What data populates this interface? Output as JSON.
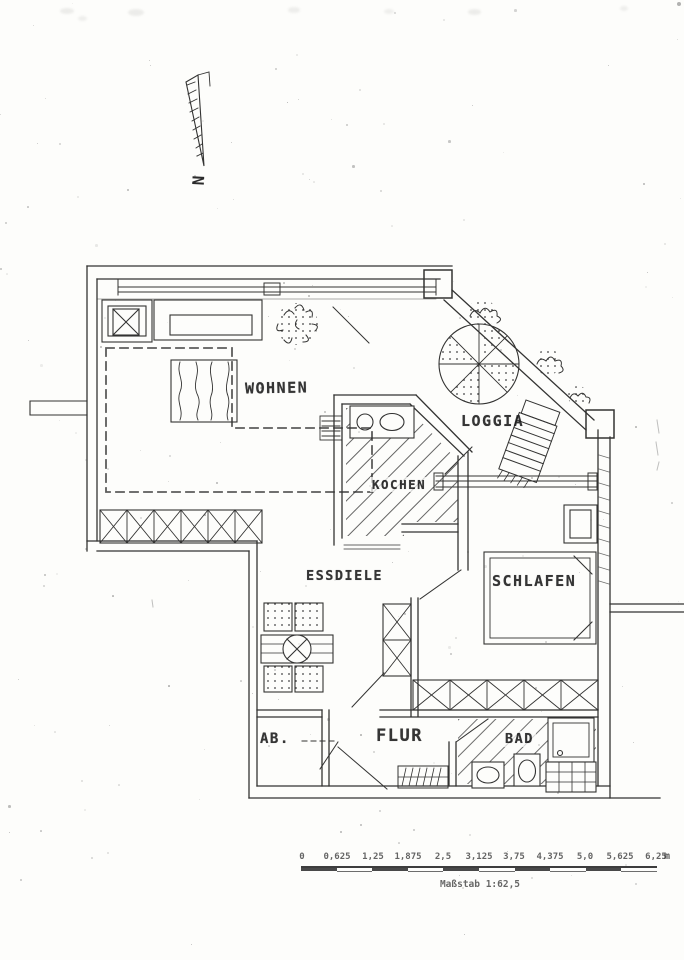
{
  "north": {
    "label": "N"
  },
  "rooms": {
    "wohnen": "WOHNEN",
    "loggia": "LOGGIA",
    "kochen": "KOCHEN",
    "essdiele": "ESSDIELE",
    "schlafen": "SCHLAFEN",
    "ab": "AB.",
    "flur": "FLUR",
    "bad": "BAD"
  },
  "scale_bar": {
    "ticks": [
      "0",
      "0,625",
      "1,25",
      "1,875",
      "2,5",
      "3,125",
      "3,75",
      "4,375",
      "5,0",
      "5,625",
      "6,25"
    ],
    "unit": "m",
    "caption": "Maßstab 1:62,5"
  },
  "colors": {
    "ink": "#1e1e1e",
    "paper": "#fdfdfb"
  }
}
